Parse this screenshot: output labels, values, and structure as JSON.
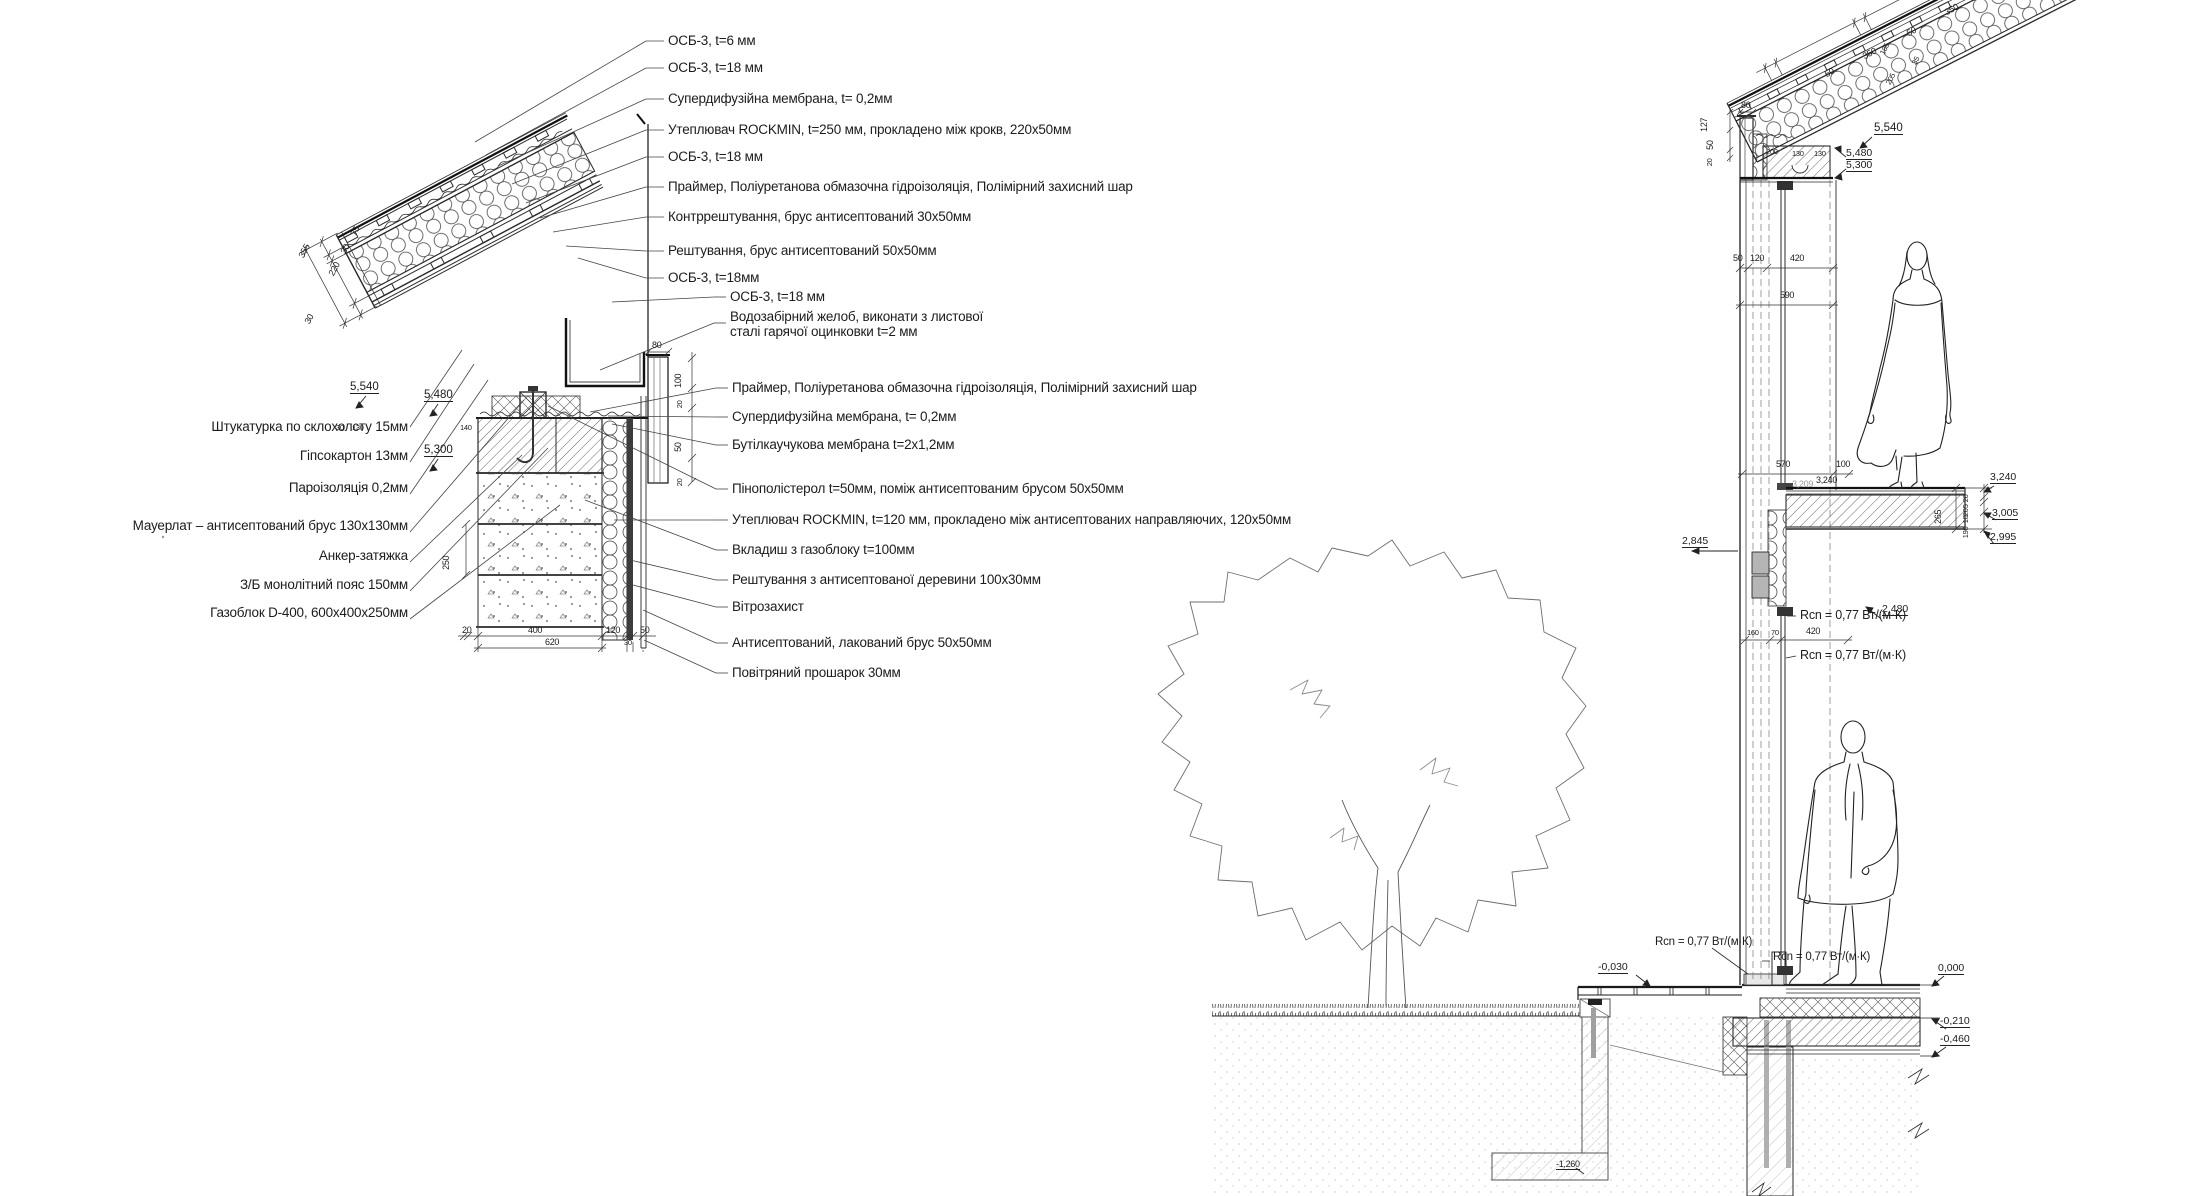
{
  "left_detail": {
    "labels_left": [
      "Штукатурка по склохолсту 15мм",
      "Гіпсокартон 13мм",
      "Пароізоляція 0,2мм",
      "Мауерлат – антисептований брус 130х130мм",
      "Анкер-затяжка",
      "З/Б монолітний пояс 150мм",
      "Газоблок D-400, 600х400х250мм"
    ],
    "labels_right": [
      "ОСБ-3, t=6 мм",
      "ОСБ-3, t=18 мм",
      "Супердифузійна мембрана, t= 0,2мм",
      "Утеплювач ROCKMIN, t=250 мм, прокладено між крокв, 220х50мм",
      "ОСБ-3, t=18 мм",
      "Праймер, Поліуретанова обмазочна гідроізоляція, Полімірний захисний шар",
      "Контррештування, брус антисептований 30х50мм",
      "Рештування, брус антисептований 50х50мм",
      "ОСБ-3, t=18мм",
      "ОСБ-3, t=18 мм"
    ],
    "gutter_line1": "Водозабірний желоб, виконати з листової",
    "gutter_line2": "сталі гарячої оцинковки t=2 мм",
    "labels_right2": [
      "Праймер, Поліуретанова обмазочна гідроізоляція, Полімірний захисний шар",
      "Супердифузійна мембрана, t= 0,2мм",
      "Бутілкаучукова мембрана t=2х1,2мм",
      "Пінополістерол t=50мм, поміж антисептованим брусом 50х50мм",
      "Утеплювач ROCKMIN, t=120 мм, прокладено між антисептованих направляючих, 120х50мм",
      "Вкладиш з газоблоку t=100мм",
      "Рештування з антисептованої деревини 100х30мм",
      "Вітрозахист",
      "Антисептований, лакований брус 50х50мм",
      "Повітряний прошарок 30мм"
    ],
    "elev": [
      "5,540",
      "5,480",
      "5,300"
    ],
    "roof_chain": [
      "30",
      "220",
      "30",
      "75",
      "355"
    ],
    "bottom_chain": [
      "20",
      "400",
      "120",
      "30",
      "50",
      "620"
    ],
    "side_chain": [
      "80",
      "100",
      "20",
      "50",
      "20"
    ],
    "inner_dims": [
      "30",
      "130",
      "140",
      "250"
    ]
  },
  "right_section": {
    "rcn": "Rcn = 0,77 Вт/(м·К)",
    "roof_chain": [
      "50",
      "350",
      "50",
      "350",
      "50"
    ],
    "roof_cross": [
      "185",
      "35",
      "205"
    ],
    "eave_dims": [
      "127",
      "80",
      "50",
      "20"
    ],
    "lintel_dims": [
      "200",
      "130",
      "130"
    ],
    "wall_chain": [
      "50",
      "120",
      "420",
      "590"
    ],
    "floor_dims": [
      "570",
      "100",
      "3,209",
      "3,240",
      "265"
    ],
    "stack_dims": [
      "20",
      "5",
      "20",
      "10",
      "190"
    ],
    "mid_chain": [
      "160",
      "70",
      "420"
    ],
    "elev": {
      "r5540": "5,540",
      "r5480": "5,480",
      "r5300": "5,300",
      "r3240": "3,240",
      "r3005": "3,005",
      "r2995": "2,995",
      "r2845": "2,845",
      "r2480": "2,480",
      "g030": "-0,030",
      "g000": "0,000",
      "g210": "-0,210",
      "g460": "-0,460",
      "g1260": "-1,260"
    }
  }
}
